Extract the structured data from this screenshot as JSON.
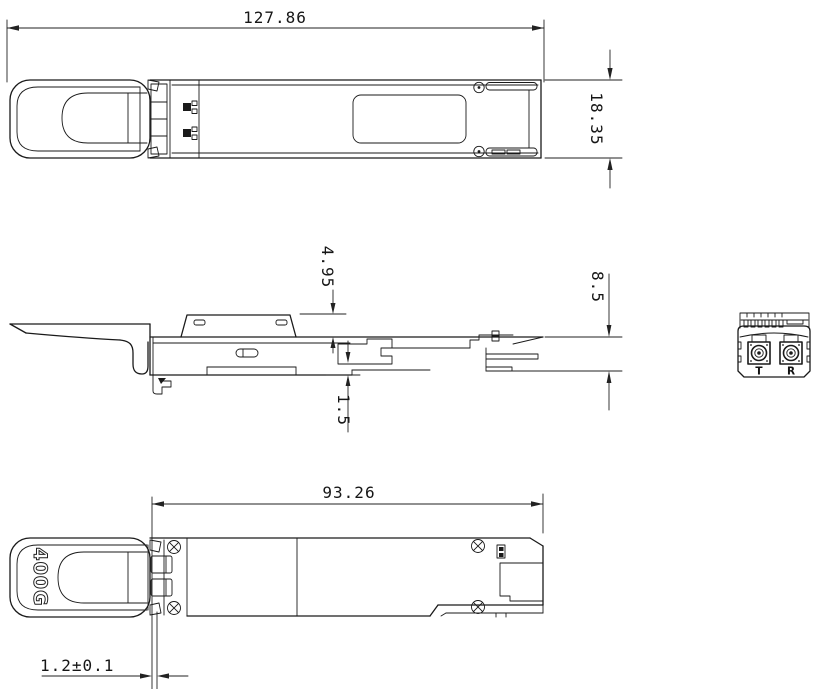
{
  "drawing": {
    "background_color": "#ffffff",
    "line_color": "#1a1a1a"
  },
  "dimensions": {
    "top_length": "127.86",
    "top_width": "18.35",
    "side_block_height": "4.95",
    "side_body_height": "8.5",
    "side_bottom_step": "1.5",
    "bottom_body_length": "93.26",
    "bottom_latch_offset": "1.2±0.1"
  },
  "labels": {
    "module_marking": "400G",
    "port_transmit": "T",
    "port_receive": "R"
  }
}
